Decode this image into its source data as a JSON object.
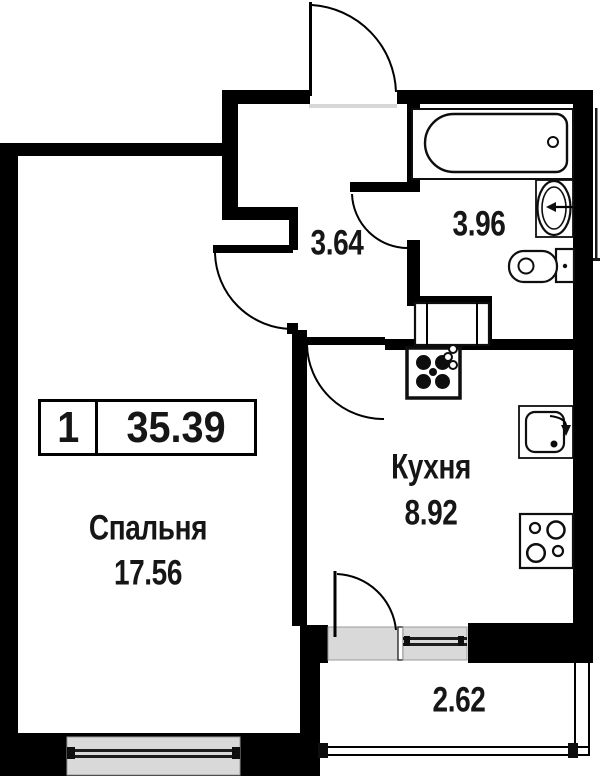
{
  "badge": {
    "rooms_count": "1",
    "total_area": "35.39"
  },
  "rooms": {
    "bedroom": {
      "label": "Спальня",
      "area": "17.56"
    },
    "kitchen": {
      "label": "Кухня",
      "area": "8.92"
    },
    "hallway": {
      "area": "3.64"
    },
    "bathroom": {
      "area": "3.96"
    },
    "balcony": {
      "area": "2.62"
    }
  },
  "fixtures": [
    "bathtub",
    "washbasin",
    "toilet",
    "washing-machine",
    "ventilation-fan",
    "kitchen-sink",
    "stove"
  ],
  "colors": {
    "wall": "#000000",
    "window_fill": "#d9d9d9",
    "text": "#161616",
    "background": "#ffffff"
  }
}
